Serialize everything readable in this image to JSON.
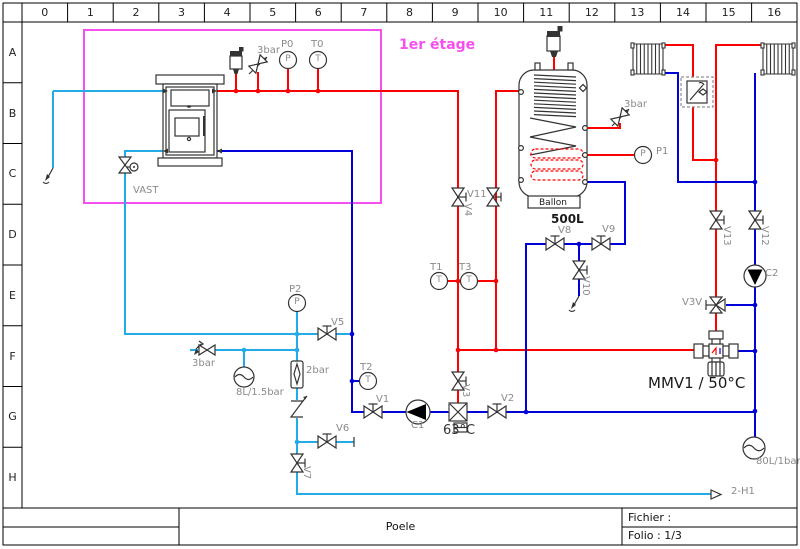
{
  "frame": {
    "columns": [
      "0",
      "1",
      "2",
      "3",
      "4",
      "5",
      "6",
      "7",
      "8",
      "9",
      "10",
      "11",
      "12",
      "13",
      "14",
      "15",
      "16"
    ],
    "rows": [
      "A",
      "B",
      "C",
      "D",
      "E",
      "F",
      "G",
      "H"
    ]
  },
  "title_block": {
    "doc_title": "Poele",
    "file_label": "Fichier :",
    "folio_label": "Folio : 1/3"
  },
  "colors": {
    "hot": "#fd0000",
    "ret": "#0000d8",
    "cold": "#23abe8",
    "zone": "#f64ff0",
    "gray": "#8a8a8a",
    "ink": "#1a1a1a",
    "ink2": "#333333"
  },
  "zone": {
    "label": "1er étage"
  },
  "labels": [
    {
      "id": "p0",
      "t": "P0",
      "x": 281,
      "y": 40
    },
    {
      "id": "t0",
      "t": "T0",
      "x": 311,
      "y": 40
    },
    {
      "id": "relief-stove",
      "t": "3bar",
      "x": 257,
      "y": 46
    },
    {
      "id": "zone",
      "t": "1er étage",
      "x": 399,
      "y": 38,
      "fs": 14,
      "c": "zone",
      "b": 1
    },
    {
      "id": "vast",
      "t": "VAST",
      "x": 133,
      "y": 186
    },
    {
      "id": "ballon",
      "t": "Ballon",
      "x": 539,
      "y": 199,
      "fs": 9,
      "c": "ink"
    },
    {
      "id": "tank-volume",
      "t": "500L",
      "x": 551,
      "y": 213,
      "fs": 12,
      "c": "ink",
      "b": 1
    },
    {
      "id": "relief-tank",
      "t": "3bar",
      "x": 624,
      "y": 100
    },
    {
      "id": "p1",
      "t": "P1",
      "x": 656,
      "y": 147
    },
    {
      "id": "v4",
      "t": "V4",
      "x": 472,
      "y": 203,
      "r": 90
    },
    {
      "id": "v11",
      "t": "V11",
      "x": 467,
      "y": 190
    },
    {
      "id": "t1",
      "t": "T1",
      "x": 430,
      "y": 263
    },
    {
      "id": "t3",
      "t": "T3",
      "x": 459,
      "y": 263
    },
    {
      "id": "v8",
      "t": "V8",
      "x": 558,
      "y": 226
    },
    {
      "id": "v9",
      "t": "V9",
      "x": 602,
      "y": 225
    },
    {
      "id": "v10",
      "t": "V10",
      "x": 590,
      "y": 276,
      "r": 90
    },
    {
      "id": "v13",
      "t": "V13",
      "x": 731,
      "y": 226,
      "r": 90
    },
    {
      "id": "v12",
      "t": "V12",
      "x": 769,
      "y": 226,
      "r": 90
    },
    {
      "id": "c2",
      "t": "C2",
      "x": 765,
      "y": 269
    },
    {
      "id": "v3v",
      "t": "V3V",
      "x": 682,
      "y": 298
    },
    {
      "id": "mmv",
      "t": "MMV1 / 50°C",
      "x": 648,
      "y": 376,
      "fs": 15,
      "c": "ink"
    },
    {
      "id": "p2",
      "t": "P2",
      "x": 289,
      "y": 285
    },
    {
      "id": "v5",
      "t": "V5",
      "x": 331,
      "y": 318
    },
    {
      "id": "relief-cold",
      "t": "3bar",
      "x": 192,
      "y": 359
    },
    {
      "id": "vessel-8l",
      "t": "8L/1.5bar",
      "x": 236,
      "y": 388
    },
    {
      "id": "reducer",
      "t": "2bar",
      "x": 306,
      "y": 366
    },
    {
      "id": "t2",
      "t": "T2",
      "x": 360,
      "y": 363
    },
    {
      "id": "v1",
      "t": "V1",
      "x": 376,
      "y": 395
    },
    {
      "id": "c1",
      "t": "C1",
      "x": 411,
      "y": 421
    },
    {
      "id": "temp-63",
      "t": "63°C",
      "x": 443,
      "y": 424,
      "fs": 13,
      "c": "ink2"
    },
    {
      "id": "v3",
      "t": "V3",
      "x": 470,
      "y": 384,
      "r": 90
    },
    {
      "id": "v2",
      "t": "V2",
      "x": 501,
      "y": 394
    },
    {
      "id": "v6",
      "t": "V6",
      "x": 336,
      "y": 424
    },
    {
      "id": "v7",
      "t": "V7",
      "x": 311,
      "y": 466,
      "r": 90
    },
    {
      "id": "vessel-80l",
      "t": "80L/1bar",
      "x": 756,
      "y": 457
    },
    {
      "id": "outlet",
      "t": "2-H1",
      "x": 731,
      "y": 487
    },
    {
      "id": "p0-glyph",
      "t": "P",
      "x": 288,
      "y": 60,
      "fs": 9,
      "ctr": 1
    },
    {
      "id": "t0-glyph",
      "t": "T",
      "x": 318,
      "y": 60,
      "fs": 9,
      "ctr": 1
    },
    {
      "id": "p2-glyph",
      "t": "P",
      "x": 297,
      "y": 303,
      "fs": 9,
      "ctr": 1
    },
    {
      "id": "p1-glyph",
      "t": "P",
      "x": 643,
      "y": 155,
      "fs": 9,
      "ctr": 1
    },
    {
      "id": "t1-glyph",
      "t": "T",
      "x": 439,
      "y": 281,
      "fs": 9,
      "ctr": 1
    },
    {
      "id": "t3-glyph",
      "t": "T",
      "x": 469,
      "y": 281,
      "fs": 9,
      "ctr": 1
    },
    {
      "id": "t2-glyph",
      "t": "T",
      "x": 368,
      "y": 381,
      "fs": 9,
      "ctr": 1
    }
  ]
}
